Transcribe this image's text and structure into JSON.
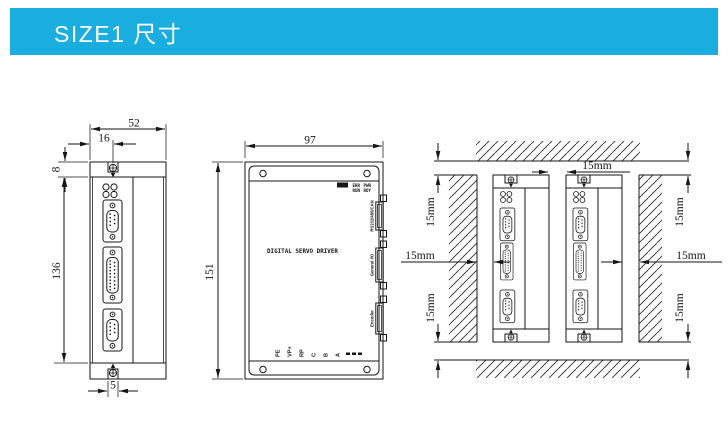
{
  "header": {
    "title": "SIZE1 尺寸",
    "bar_color": "#1aade0"
  },
  "front_view": {
    "dim_width": "52",
    "dim_slot_offset": "16",
    "dim_flange_height": "8",
    "dim_body_height": "136",
    "dim_slot_width": "5"
  },
  "side_view": {
    "dim_width": "97",
    "dim_height": "151",
    "panel_title": "DIGITAL SERVO DRIVER",
    "led_labels": [
      "ERR",
      "PWR",
      "RUN",
      "RDY"
    ],
    "connectors": [
      "RS232/485/CAN",
      "General I/O",
      "Encoder"
    ],
    "terminals": [
      "PE",
      "VP+",
      "RP",
      "C",
      "B",
      "A"
    ]
  },
  "mounting_view": {
    "clearance_between": "15mm",
    "clearance_top_left": "15mm",
    "clearance_bottom_left": "15mm",
    "clearance_top_right": "15mm",
    "clearance_bottom_right": "15mm",
    "clearance_left": "15mm",
    "clearance_right": "15mm"
  }
}
